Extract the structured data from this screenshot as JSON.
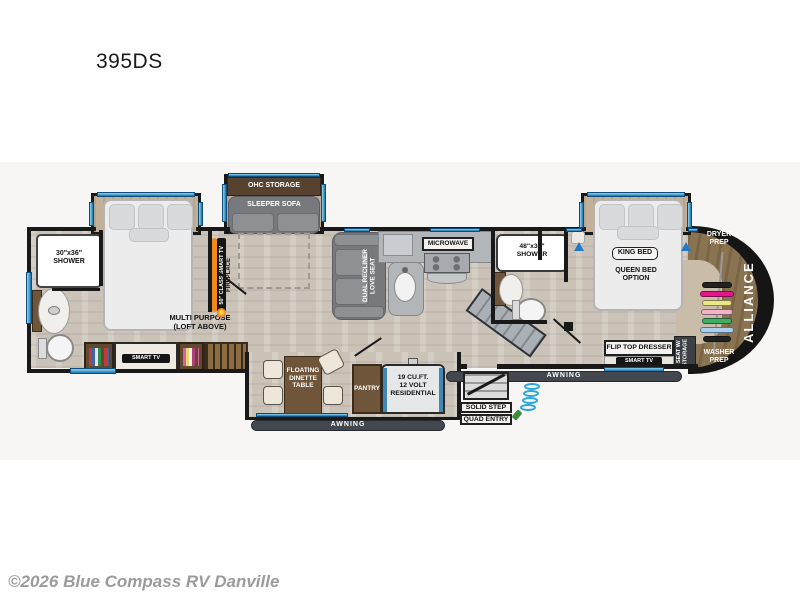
{
  "title": "395DS",
  "copyright": "©2026 Blue Compass RV Danville",
  "rooms": {
    "bath1_shower": "30\"x36\"\nSHOWER",
    "multi_purpose": "MULTI PURPOSE\n(LOFT ABOVE)",
    "bed1_tv": "SMART TV",
    "wall_tv": "50\" CLASS SMART TV",
    "fireplace": "FIREPLACE",
    "ohc_storage": "OHC STORAGE",
    "sleeper_sofa": "SLEEPER SOFA",
    "loveseat": "DUAL RECLINER\nLOVE SEAT",
    "microwave": "MICROWAVE",
    "dinette": "FLOATING\nDINETTE\nTABLE",
    "pantry": "PANTRY",
    "fridge": "19 CU.FT.\n12 VOLT\nRESIDENTIAL",
    "awning_left": "AWNING",
    "awning_right": "AWNING",
    "solid_step": "SOLID STEP",
    "quad_entry": "QUAD ENTRY",
    "bath2_shower": "48\"x30\"\nSHOWER",
    "king_bed": "KING BED",
    "queen_option": "QUEEN BED\nOPTION",
    "dryer_prep": "DRYER\nPREP",
    "washer_prep": "WASHER\nPREP",
    "brand": "ALLIANCE",
    "flip_top_dresser": "FLIP TOP DRESSER",
    "bed2_tv": "SMART TV",
    "seat_storage": "SEAT W/\nSTORAGE"
  },
  "colors": {
    "window_blue": "#3fa8dd",
    "accent_orange": "#f08a1d",
    "wall": "#191919",
    "floor": "#cbc3b8",
    "front_cap_brown": "#8a7350"
  }
}
